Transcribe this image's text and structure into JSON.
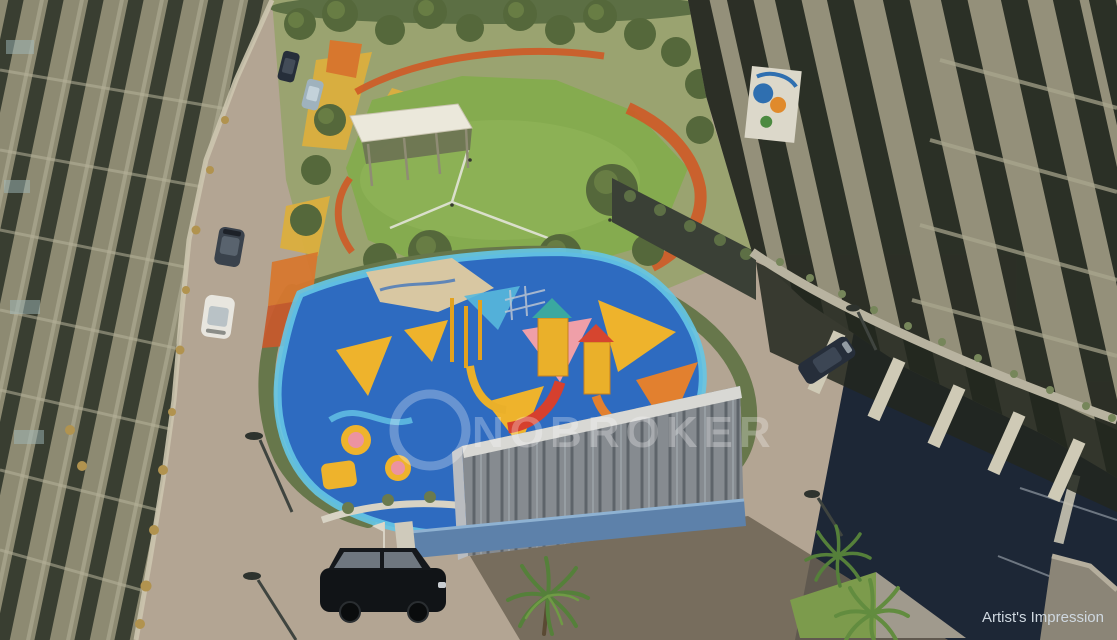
{
  "watermark": {
    "brand_text": "NOBROKER",
    "logo_name": "nobroker-ring-logo"
  },
  "credit": {
    "label": "Artist's Impression"
  },
  "palette": {
    "road": "#b3a593",
    "shadow_navy": "#1d2736",
    "wall_shadow": "#6c6354",
    "lawn": "#85ab4f",
    "park_ground": "#9aa370",
    "tree": "#55683b",
    "hedge": "#67774b",
    "building_left": "#8d8a72",
    "building_right": "#94907a",
    "window_strip": "#23281f",
    "playground_blue": "#2e6bc0",
    "playground_border": "#65c6e6",
    "sand": "#d8c7a2",
    "play_yellow": "#eeb32c",
    "play_orange": "#e2802f",
    "play_pink": "#ef9fa8",
    "play_red": "#d6402e",
    "water_wall": "#868b90",
    "pool_blue": "#5d81aa",
    "track_orange": "#cf5a26",
    "path_yellow": "#dcaf3e",
    "pavilion_roof": "#ebe8db",
    "palm_green": "#55803a",
    "car_white": "#e8e6df",
    "car_black": "#111417",
    "car_navy": "#262e3a",
    "car_gray": "#3a424c",
    "car_silver": "#9fb2bd",
    "credit_text": "#cfd8e0"
  },
  "scene": {
    "objects": [
      "apartment-towers-left",
      "apartment-towers-right",
      "internal-paved-road",
      "central-lawn-park",
      "jogging-track",
      "garden-pavilion",
      "kids-playground",
      "water-feature-wall",
      "shade-sails",
      "cars-on-road",
      "black-suv",
      "palm-trees",
      "street-lamps"
    ]
  }
}
